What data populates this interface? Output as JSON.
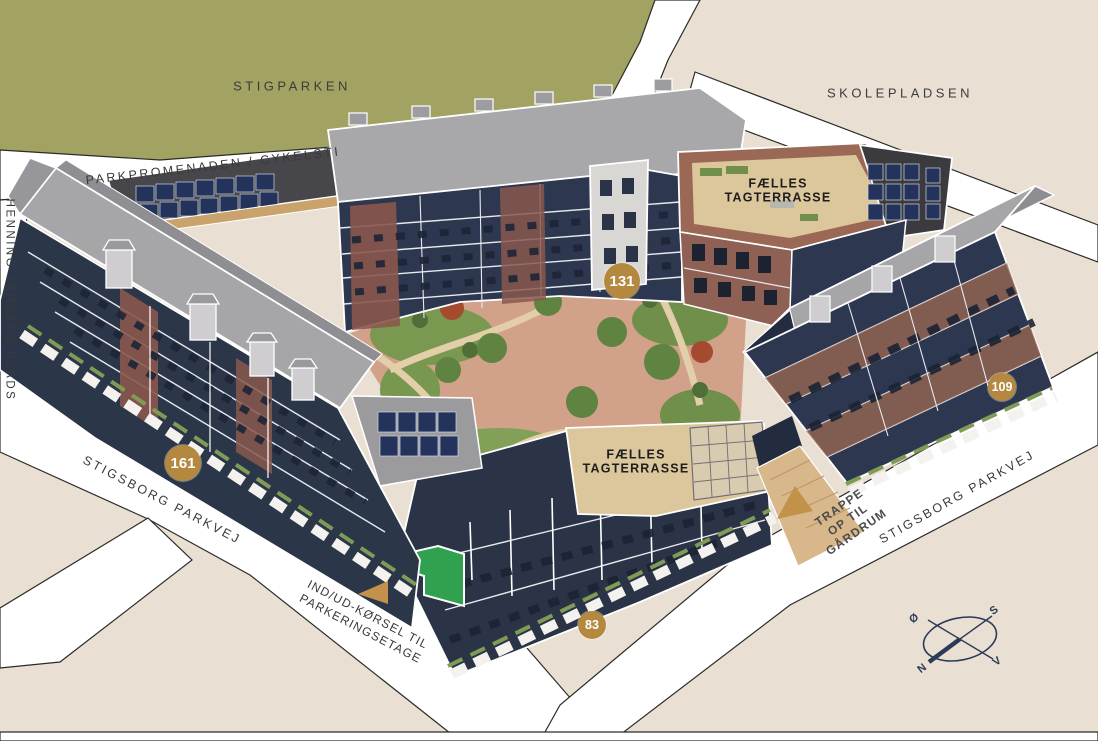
{
  "title": "Stigsborg housing block site plan",
  "areas": {
    "park": "STIGPARKEN",
    "plaza": "SKOLEPLADSEN"
  },
  "streets": {
    "promenade": "PARKPROMENADEN / CYKELSTI",
    "plads": "HENNING JENSENS PLADS",
    "parkvej": "STIGSBORG PARKVEJ"
  },
  "annotations": {
    "roof_terrace": "FÆLLES\nTAGTERRASSE",
    "parking_entrance": "IND/UD-KØRSEL TIL\nPARKERINGSETAGE",
    "stairs": "TRAPPE\nOP TIL\nGÅRDRUM"
  },
  "badges": [
    {
      "value": "131"
    },
    {
      "value": "161"
    },
    {
      "value": "109"
    },
    {
      "value": "83"
    }
  ],
  "compass": {
    "east": "Ø",
    "south": "S",
    "north": "N",
    "west": "V"
  },
  "colors": {
    "background_beige": "#e9e0d3",
    "park_green": "#a2a263",
    "road_white": "#ffffff",
    "road_outline": "#2b2b28",
    "facade_navy": "#2d3850",
    "roof_gray": "#a8a8ab",
    "brick_red": "#8d5c50",
    "deck_wood": "#dcc69c",
    "solar_blue": "#24335c",
    "courtyard_paving": "#d2a189",
    "courtyard_green": "#7a9850",
    "badge_gold": "#b5883f",
    "highlight_green": "#2fa14f",
    "compass_navy": "#2c3a57",
    "label_dark": "#3a3a3a"
  }
}
